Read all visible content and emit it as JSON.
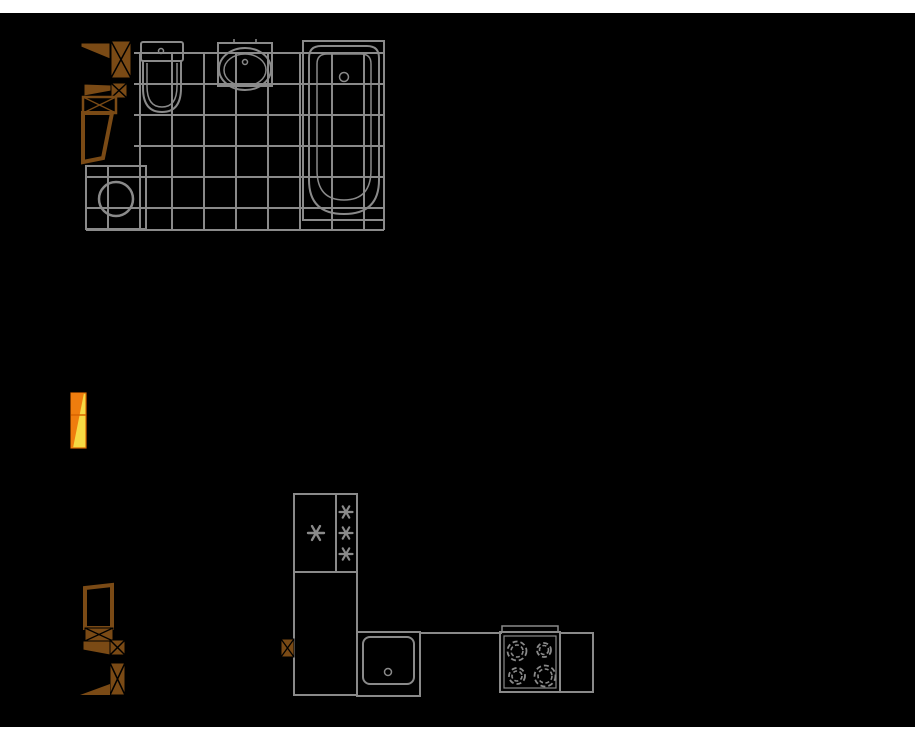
{
  "palette": {
    "gray": "#8a8a8a",
    "brown": "#7a4a15",
    "black": "#000000",
    "white": "#ffffff",
    "yellow": "#f6d943",
    "orange": "#ef7d0e",
    "orange_dark": "#d96400"
  },
  "drawing": {
    "width": 915,
    "height": 739,
    "background": {
      "name": "plan-canvas",
      "x": 0,
      "y": 13,
      "w": 915,
      "h": 714,
      "fill": "black"
    },
    "groups": [
      {
        "name": "bathroom-tiled-floor",
        "interactable": false,
        "shapes": [
          {
            "t": "line",
            "name": "tile-hline",
            "x1": 134,
            "y1": 53,
            "x2": 384,
            "y2": 53,
            "sw": 2
          },
          {
            "t": "line",
            "name": "tile-hline",
            "x1": 134,
            "y1": 84,
            "x2": 384,
            "y2": 84,
            "sw": 2
          },
          {
            "t": "line",
            "name": "tile-hline",
            "x1": 134,
            "y1": 115,
            "x2": 384,
            "y2": 115,
            "sw": 2
          },
          {
            "t": "line",
            "name": "tile-hline",
            "x1": 134,
            "y1": 146,
            "x2": 384,
            "y2": 146,
            "sw": 2
          },
          {
            "t": "line",
            "name": "tile-hline",
            "x1": 86,
            "y1": 177,
            "x2": 384,
            "y2": 177,
            "sw": 2
          },
          {
            "t": "line",
            "name": "tile-hline",
            "x1": 86,
            "y1": 208,
            "x2": 384,
            "y2": 208,
            "sw": 2
          },
          {
            "t": "line",
            "name": "tile-hline",
            "x1": 86,
            "y1": 230,
            "x2": 384,
            "y2": 230,
            "sw": 2
          },
          {
            "t": "line",
            "name": "tile-vline",
            "x1": 108,
            "y1": 166,
            "x2": 108,
            "y2": 230,
            "sw": 2
          },
          {
            "t": "line",
            "name": "tile-vline",
            "x1": 140,
            "y1": 53,
            "x2": 140,
            "y2": 230,
            "sw": 2
          },
          {
            "t": "line",
            "name": "tile-vline",
            "x1": 172,
            "y1": 53,
            "x2": 172,
            "y2": 230,
            "sw": 2
          },
          {
            "t": "line",
            "name": "tile-vline",
            "x1": 204,
            "y1": 53,
            "x2": 204,
            "y2": 230,
            "sw": 2
          },
          {
            "t": "line",
            "name": "tile-vline",
            "x1": 236,
            "y1": 53,
            "x2": 236,
            "y2": 230,
            "sw": 2
          },
          {
            "t": "line",
            "name": "tile-vline",
            "x1": 268,
            "y1": 53,
            "x2": 268,
            "y2": 230,
            "sw": 2
          },
          {
            "t": "line",
            "name": "tile-vline",
            "x1": 300,
            "y1": 53,
            "x2": 300,
            "y2": 230,
            "sw": 2
          },
          {
            "t": "line",
            "name": "tile-vline",
            "x1": 332,
            "y1": 53,
            "x2": 332,
            "y2": 230,
            "sw": 2
          },
          {
            "t": "line",
            "name": "tile-vline",
            "x1": 364,
            "y1": 53,
            "x2": 364,
            "y2": 230,
            "sw": 2
          },
          {
            "t": "line",
            "name": "tile-vline",
            "x1": 384,
            "y1": 53,
            "x2": 384,
            "y2": 230,
            "sw": 2
          }
        ]
      },
      {
        "name": "washing-machine",
        "interactable": true,
        "shapes": [
          {
            "t": "rect",
            "name": "washing-machine-body",
            "x": 86,
            "y": 166,
            "w": 60,
            "h": 63,
            "sw": 2
          },
          {
            "t": "circle",
            "name": "washing-machine-drum",
            "cx": 116,
            "cy": 199,
            "r": 17,
            "sw": 2.5
          }
        ]
      },
      {
        "name": "toilet",
        "interactable": true,
        "shapes": [
          {
            "t": "rect",
            "name": "toilet-tank",
            "x": 141,
            "y": 42,
            "w": 42,
            "h": 19,
            "rx": 2,
            "sw": 2
          },
          {
            "t": "circle",
            "name": "toilet-button",
            "cx": 161,
            "cy": 51,
            "r": 2.5,
            "sw": 1.5
          },
          {
            "t": "path",
            "name": "toilet-bowl-outer",
            "d": "M143,61 V88 Q143,112 162,112 Q181,112 181,88 V61",
            "sw": 2
          },
          {
            "t": "path",
            "name": "toilet-bowl-inner",
            "d": "M147,63 V86 Q147,107 162,107 Q177,107 177,86 V63",
            "sw": 1.5
          }
        ]
      },
      {
        "name": "wash-basin",
        "interactable": true,
        "shapes": [
          {
            "t": "rect",
            "name": "basin-counter",
            "x": 218,
            "y": 43,
            "w": 54,
            "h": 43,
            "sw": 2
          },
          {
            "t": "ellipse",
            "name": "basin-rim",
            "cx": 245,
            "cy": 69,
            "rx": 26,
            "ry": 21,
            "sw": 2
          },
          {
            "t": "ellipse",
            "name": "basin-bowl",
            "cx": 245,
            "cy": 70,
            "rx": 21,
            "ry": 16,
            "sw": 1.5
          },
          {
            "t": "circle",
            "name": "basin-drain",
            "cx": 245,
            "cy": 62,
            "r": 2.5,
            "sw": 1.5
          },
          {
            "t": "line",
            "name": "basin-tap-tick",
            "x1": 234,
            "y1": 39,
            "x2": 234,
            "y2": 44,
            "sw": 1.5
          },
          {
            "t": "line",
            "name": "basin-tap-tick",
            "x1": 256,
            "y1": 39,
            "x2": 256,
            "y2": 44,
            "sw": 1.5
          }
        ]
      },
      {
        "name": "bathtub",
        "interactable": true,
        "shapes": [
          {
            "t": "rect",
            "name": "bathtub-outer",
            "x": 303,
            "y": 41,
            "w": 81,
            "h": 179,
            "sw": 2
          },
          {
            "t": "path",
            "name": "bathtub-rim",
            "d": "M309,58 Q309,46 321,46 L367,46 Q379,46 379,58 L379,180 Q379,214 344,214 Q309,214 309,180 Z",
            "sw": 2
          },
          {
            "t": "path",
            "name": "bathtub-basin",
            "d": "M317,64 Q317,54 327,54 L361,54 Q371,54 371,64 L371,170 Q371,200 344,200 Q317,200 317,170 Z",
            "sw": 1.5
          },
          {
            "t": "circle",
            "name": "bathtub-drain",
            "cx": 344,
            "cy": 77,
            "r": 4.5,
            "sw": 1.5
          }
        ]
      },
      {
        "name": "bathroom-door-top",
        "interactable": true,
        "shapes": [
          {
            "t": "polygon",
            "name": "door-leaf",
            "pts": [
              [
                81,
                43
              ],
              [
                110,
                43
              ],
              [
                110,
                59
              ],
              [
                81,
                47
              ]
            ],
            "fill": "brown",
            "stroke": "black",
            "sw": 1
          },
          {
            "t": "xbox",
            "name": "door-jamb",
            "x": 111,
            "y": 41,
            "w": 20,
            "h": 37,
            "fill": "brown",
            "stroke": "black",
            "sw": 1,
            "xstroke": "black",
            "xsw": 1.5
          }
        ]
      },
      {
        "name": "bathroom-door-middle",
        "interactable": true,
        "shapes": [
          {
            "t": "polygon",
            "name": "door-leaf",
            "pts": [
              [
                84,
                84
              ],
              [
                111,
                85
              ],
              [
                111,
                91
              ],
              [
                84,
                96
              ]
            ],
            "fill": "brown",
            "stroke": "black",
            "sw": 1
          },
          {
            "t": "xbox",
            "name": "door-jamb",
            "x": 111,
            "y": 83,
            "w": 16,
            "h": 15,
            "fill": "brown",
            "stroke": "black",
            "sw": 1,
            "xstroke": "black",
            "xsw": 1.5
          },
          {
            "t": "xbox",
            "name": "door-frame-box",
            "x": 83,
            "y": 97,
            "w": 33,
            "h": 16,
            "fill": "black",
            "stroke": "brown",
            "sw": 2.5,
            "xstroke": "brown",
            "xsw": 1.3
          }
        ]
      },
      {
        "name": "bathroom-door-bottom",
        "interactable": true,
        "shapes": [
          {
            "t": "polygon",
            "name": "door-leaf-frame",
            "pts": [
              [
                83,
                113
              ],
              [
                112,
                113
              ],
              [
                103,
                158
              ],
              [
                83,
                162
              ]
            ],
            "fill": "black",
            "stroke": "brown",
            "sw": 4
          }
        ]
      },
      {
        "name": "hall-door-yellow",
        "interactable": true,
        "shapes": [
          {
            "t": "rect",
            "name": "yellow-door-leaf",
            "x": 71,
            "y": 393,
            "w": 15,
            "h": 55,
            "fill": "yellow",
            "stroke": "orange_dark",
            "sw": 1.2
          },
          {
            "t": "polygon",
            "name": "yellow-door-shade",
            "pts": [
              [
                71,
                393
              ],
              [
                84,
                393
              ],
              [
                73,
                448
              ],
              [
                71,
                448
              ]
            ],
            "fill": "orange"
          },
          {
            "t": "line",
            "name": "yellow-door-divider",
            "x1": 71,
            "y1": 415,
            "x2": 86,
            "y2": 415,
            "stroke": "orange_dark",
            "sw": 1.5
          }
        ]
      },
      {
        "name": "entry-door-top",
        "interactable": true,
        "shapes": [
          {
            "t": "polygon",
            "name": "door-leaf-frame",
            "pts": [
              [
                85,
                588
              ],
              [
                112,
                585
              ],
              [
                112,
                628
              ],
              [
                85,
                628
              ]
            ],
            "fill": "black",
            "stroke": "brown",
            "sw": 4
          },
          {
            "t": "xbox",
            "name": "door-jamb",
            "x": 85,
            "y": 628,
            "w": 28,
            "h": 13,
            "fill": "brown",
            "stroke": "black",
            "sw": 1,
            "xstroke": "black",
            "xsw": 1.3
          }
        ]
      },
      {
        "name": "entry-door-middle",
        "interactable": true,
        "shapes": [
          {
            "t": "polygon",
            "name": "door-leaf",
            "pts": [
              [
                83,
                641
              ],
              [
                110,
                641
              ],
              [
                110,
                655
              ],
              [
                83,
                650
              ]
            ],
            "fill": "brown",
            "stroke": "black",
            "sw": 1
          },
          {
            "t": "xbox",
            "name": "door-jamb",
            "x": 110,
            "y": 640,
            "w": 15,
            "h": 15,
            "fill": "brown",
            "stroke": "black",
            "sw": 1,
            "xstroke": "black",
            "xsw": 1.5
          }
        ]
      },
      {
        "name": "entry-door-bottom",
        "interactable": true,
        "shapes": [
          {
            "t": "xbox",
            "name": "door-jamb",
            "x": 110,
            "y": 663,
            "w": 15,
            "h": 32,
            "fill": "brown",
            "stroke": "black",
            "sw": 1,
            "xstroke": "black",
            "xsw": 1.5
          },
          {
            "t": "polygon",
            "name": "door-leaf",
            "pts": [
              [
                80,
                695
              ],
              [
                110,
                684
              ],
              [
                110,
                695
              ]
            ],
            "fill": "brown"
          }
        ]
      },
      {
        "name": "kitchen-fridge",
        "interactable": true,
        "shapes": [
          {
            "t": "rect",
            "name": "fridge-body",
            "x": 294,
            "y": 494,
            "w": 63,
            "h": 78,
            "sw": 2
          },
          {
            "t": "line",
            "name": "fridge-divider",
            "x1": 336,
            "y1": 494,
            "x2": 336,
            "y2": 572,
            "sw": 2
          },
          {
            "t": "asterisk",
            "name": "freezer-star",
            "cx": 316,
            "cy": 533,
            "r": 8,
            "sw": 2.4
          },
          {
            "t": "asterisk",
            "name": "freezer-star",
            "cx": 346,
            "cy": 512,
            "r": 6.5,
            "sw": 2.2
          },
          {
            "t": "asterisk",
            "name": "freezer-star",
            "cx": 346,
            "cy": 533,
            "r": 6.5,
            "sw": 2.2
          },
          {
            "t": "asterisk",
            "name": "freezer-star",
            "cx": 346,
            "cy": 554,
            "r": 6.5,
            "sw": 2.2
          }
        ]
      },
      {
        "name": "kitchen-tall-cabinet",
        "interactable": true,
        "shapes": [
          {
            "t": "rect",
            "name": "cabinet-body",
            "x": 294,
            "y": 572,
            "w": 63,
            "h": 123,
            "sw": 2
          }
        ]
      },
      {
        "name": "kitchen-wall-connector",
        "interactable": true,
        "shapes": [
          {
            "t": "xbox",
            "name": "wall-post",
            "x": 281,
            "y": 639,
            "w": 13,
            "h": 18,
            "fill": "brown",
            "stroke": "black",
            "sw": 1,
            "xstroke": "black",
            "xsw": 1.3
          }
        ]
      },
      {
        "name": "kitchen-sink",
        "interactable": true,
        "shapes": [
          {
            "t": "rect",
            "name": "sink-cabinet",
            "x": 357,
            "y": 632,
            "w": 63,
            "h": 64,
            "sw": 2
          },
          {
            "t": "rect",
            "name": "sink-bowl",
            "x": 363,
            "y": 637,
            "w": 51,
            "h": 47,
            "rx": 7,
            "sw": 2
          },
          {
            "t": "circle",
            "name": "sink-drain",
            "cx": 388,
            "cy": 672,
            "r": 3.5,
            "sw": 1.5
          }
        ]
      },
      {
        "name": "kitchen-countertop",
        "interactable": true,
        "shapes": [
          {
            "t": "line",
            "name": "countertop-edge",
            "x1": 419,
            "y1": 633,
            "x2": 502,
            "y2": 633,
            "sw": 2
          }
        ]
      },
      {
        "name": "kitchen-stove",
        "interactable": true,
        "shapes": [
          {
            "t": "rect",
            "name": "stove-back-panel",
            "x": 502,
            "y": 626,
            "w": 56,
            "h": 6,
            "sw": 1.5
          },
          {
            "t": "rect",
            "name": "stove-outer",
            "x": 500,
            "y": 632,
            "w": 60,
            "h": 60,
            "sw": 2
          },
          {
            "t": "rect",
            "name": "stove-inner",
            "x": 504,
            "y": 636,
            "w": 52,
            "h": 52,
            "sw": 1.2
          },
          {
            "t": "circle",
            "name": "burner-ring",
            "cx": 517,
            "cy": 651,
            "r": 9.5,
            "sw": 1.8,
            "dash": "5 3"
          },
          {
            "t": "circle",
            "name": "burner-ring",
            "cx": 517,
            "cy": 651,
            "r": 6,
            "sw": 1.6,
            "dash": "4 2.5"
          },
          {
            "t": "circle",
            "name": "burner-ring",
            "cx": 544,
            "cy": 650,
            "r": 7,
            "sw": 1.8,
            "dash": "5 3"
          },
          {
            "t": "circle",
            "name": "burner-ring",
            "cx": 544,
            "cy": 650,
            "r": 4.5,
            "sw": 1.6,
            "dash": "4 2.5"
          },
          {
            "t": "circle",
            "name": "burner-ring",
            "cx": 517,
            "cy": 676,
            "r": 8,
            "sw": 1.8,
            "dash": "5 3"
          },
          {
            "t": "circle",
            "name": "burner-ring",
            "cx": 517,
            "cy": 676,
            "r": 5,
            "sw": 1.6,
            "dash": "4 2.5"
          },
          {
            "t": "circle",
            "name": "burner-ring",
            "cx": 545,
            "cy": 676,
            "r": 10.5,
            "sw": 1.8,
            "dash": "5 3"
          },
          {
            "t": "circle",
            "name": "burner-ring",
            "cx": 545,
            "cy": 676,
            "r": 7,
            "sw": 1.6,
            "dash": "4 2.5"
          }
        ]
      },
      {
        "name": "kitchen-counter-right",
        "interactable": true,
        "shapes": [
          {
            "t": "rect",
            "name": "counter-body",
            "x": 560,
            "y": 633,
            "w": 33,
            "h": 59,
            "sw": 2
          }
        ]
      }
    ]
  }
}
